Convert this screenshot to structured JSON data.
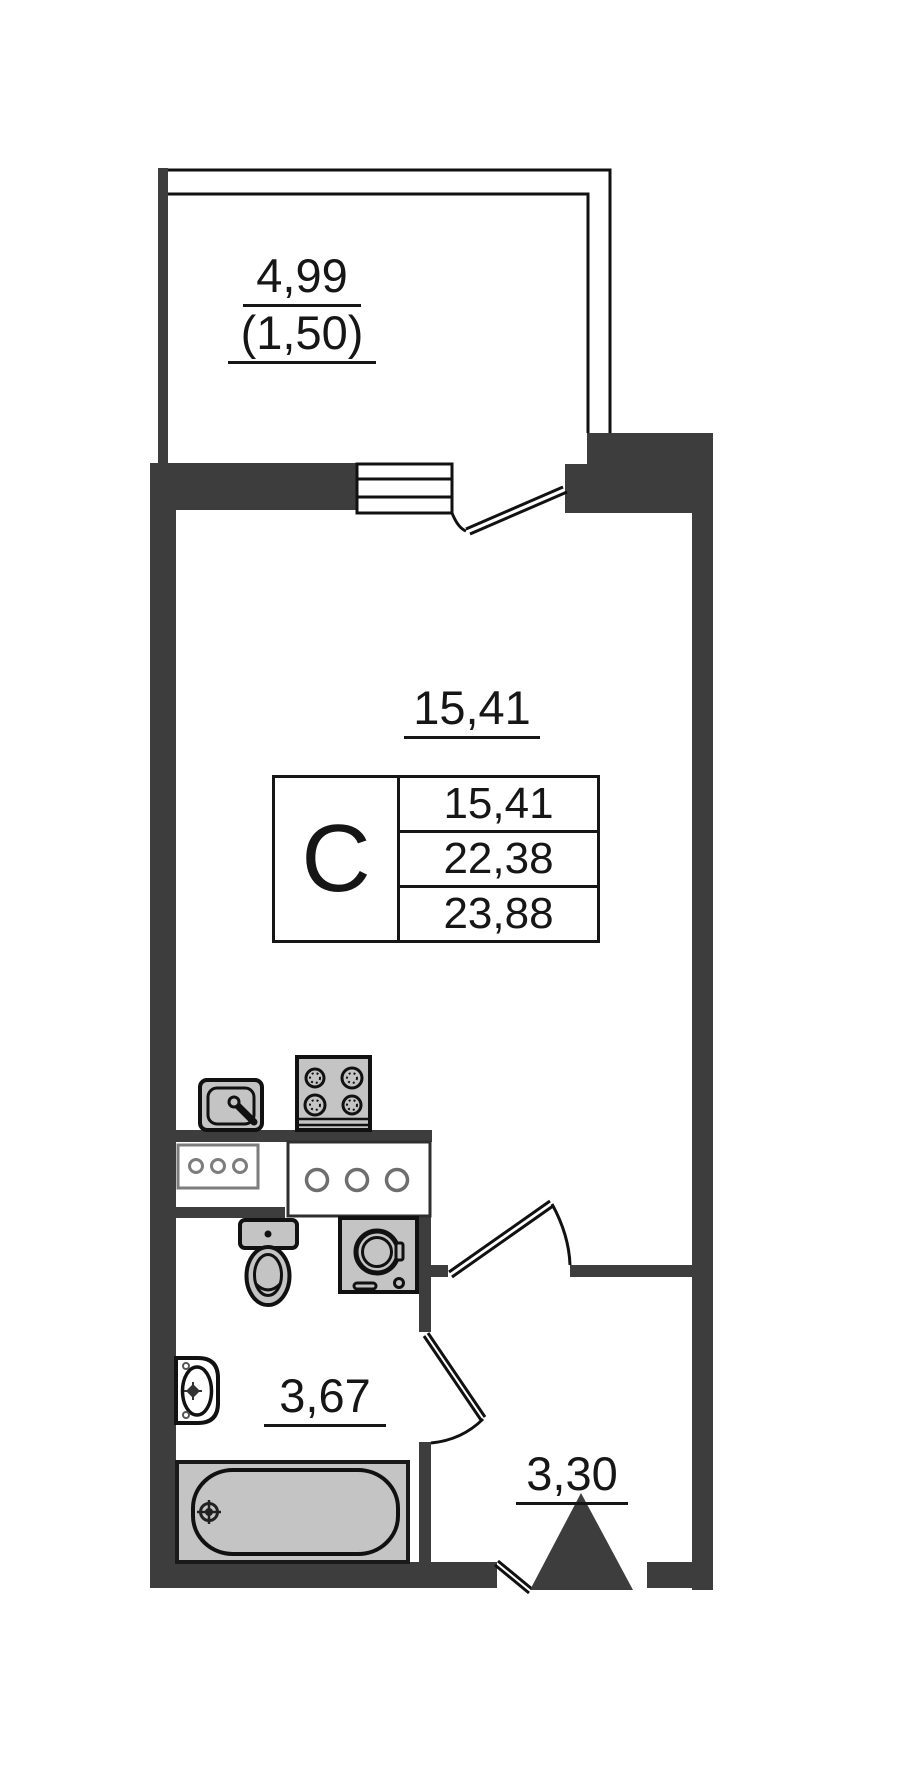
{
  "plan": {
    "title": "studio-apartment-floor-plan",
    "balcony": {
      "area": "4,99",
      "area_reduced": "(1,50)"
    },
    "room": {
      "area": "15,41"
    },
    "bathroom": {
      "area": "3,67"
    },
    "hall": {
      "area": "3,30"
    },
    "stamp": {
      "type_letter": "С",
      "living_area": "15,41",
      "apartment_area": "22,38",
      "total_area": "23,88"
    }
  },
  "icons": {
    "kitchen-sink-icon": "svg-shape",
    "stove-icon": "svg-shape",
    "vent-box-icon": "svg-shape",
    "counter-box-icon": "svg-shape",
    "toilet-icon": "svg-shape",
    "washing-machine-icon": "svg-shape",
    "washbasin-icon": "svg-shape",
    "bathtub-icon": "svg-shape",
    "entrance-triangle-icon": "svg-shape"
  },
  "colors": {
    "wall": "#3d3d3d",
    "fixture": "#c4c4c4",
    "line": "#111111",
    "bg": "#ffffff"
  }
}
